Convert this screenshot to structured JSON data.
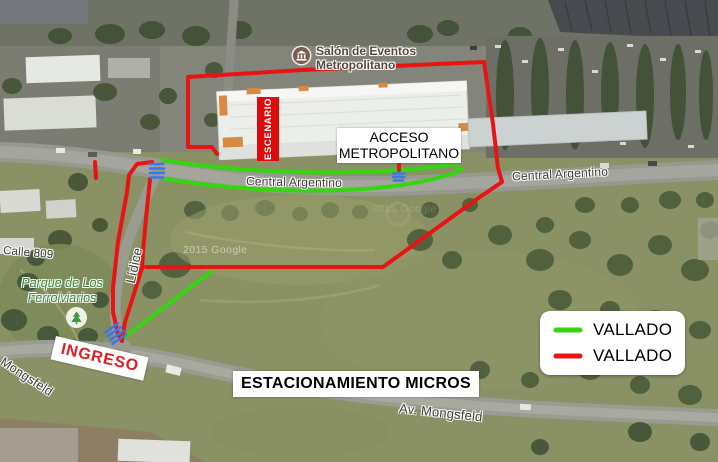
{
  "map": {
    "watermark": "2015 Google",
    "poi_salon": {
      "line1": "Salón de Eventos",
      "line2": "Metropolitano"
    },
    "poi_park": {
      "line1": "Parque de Los",
      "line2": "Ferroiviarios"
    },
    "streets": {
      "central_argentino": "Central Argentino",
      "calle_809": "Calle 809",
      "lidice": "Lídice",
      "av_mongsfeld": "Av. Mongsfeld"
    }
  },
  "annotations": {
    "escenario": {
      "label": "ESCENARIO",
      "bg": "#dd0b0b",
      "text_color": "#ffffff"
    },
    "acceso": {
      "line1": "ACCESO",
      "line2": "METROPOLITANO"
    },
    "ingreso": {
      "label": "INGRESO",
      "color": "#e21d1d"
    },
    "estacionamiento": {
      "label": "ESTACIONAMIENTO MICROS"
    },
    "gate_color": "#3b78e7",
    "green_line_color": "#33d60f",
    "red_line_color": "#e81414"
  },
  "legend": {
    "items": [
      {
        "label": "VALLADO",
        "color": "#33d60f"
      },
      {
        "label": "VALLADO",
        "color": "#e81414"
      }
    ]
  }
}
